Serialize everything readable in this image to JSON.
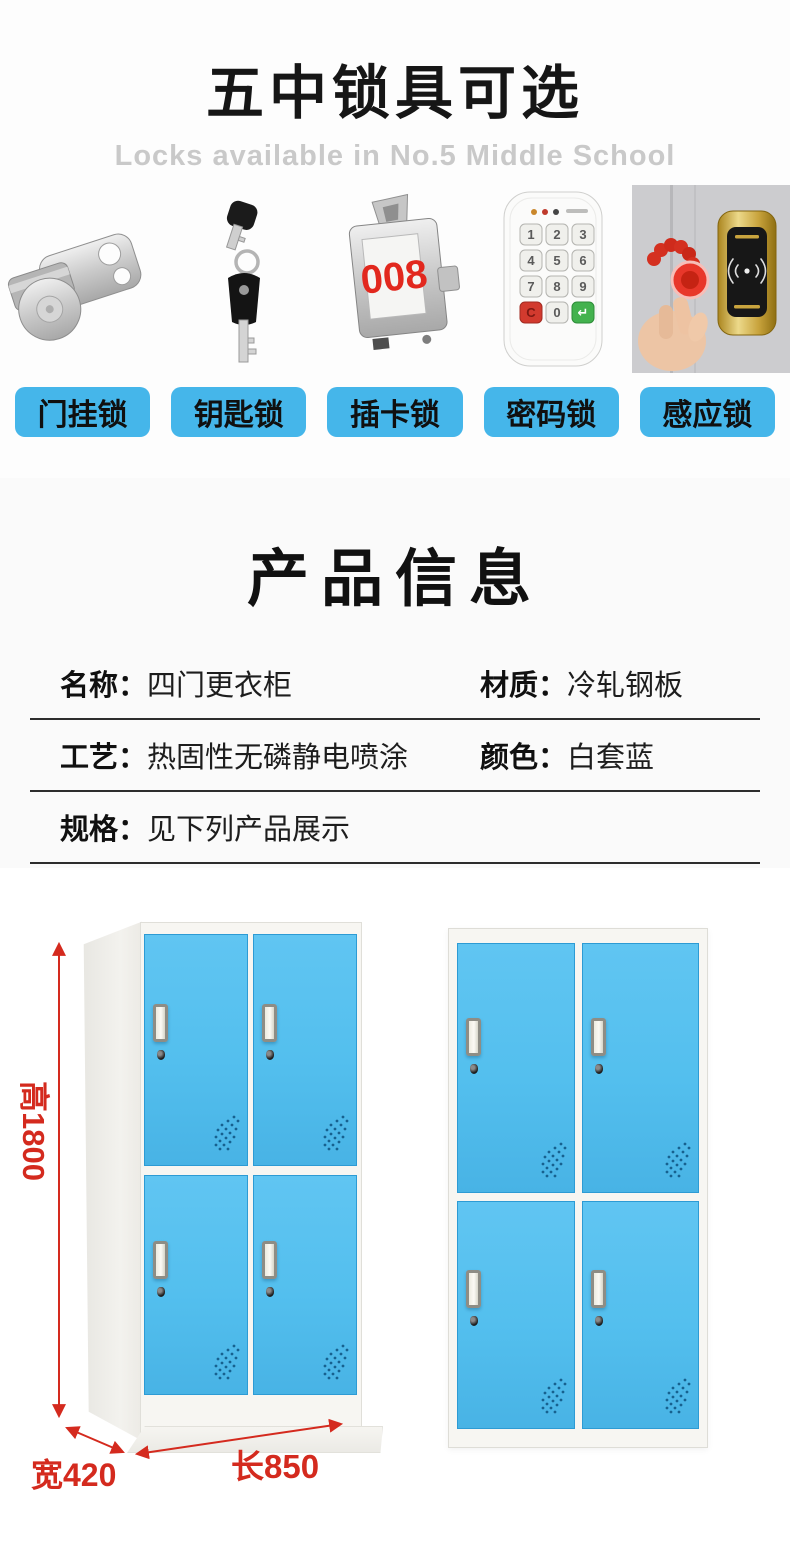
{
  "locks_section": {
    "title": "五中锁具可选",
    "subtitle": "Locks available in No.5 Middle School",
    "items": [
      {
        "label": "门挂锁",
        "image": "cam-lock"
      },
      {
        "label": "钥匙锁",
        "image": "key-lock"
      },
      {
        "label": "插卡锁",
        "image": "card-lock",
        "display": "008"
      },
      {
        "label": "密码锁",
        "image": "keypad-lock",
        "keys": [
          "1",
          "2",
          "3",
          "4",
          "5",
          "6",
          "7",
          "8",
          "9",
          "C",
          "0",
          "↵"
        ]
      },
      {
        "label": "感应锁",
        "image": "rfid-lock"
      }
    ]
  },
  "product_info": {
    "title": "产品信息",
    "fields": [
      {
        "label": "名称：",
        "value": "四门更衣柜"
      },
      {
        "label": "材质：",
        "value": "冷轧钢板"
      },
      {
        "label": "工艺：",
        "value": "热固性无磷静电喷涂"
      },
      {
        "label": "颜色：",
        "value": "白套蓝"
      },
      {
        "label": "规格：",
        "value": "见下列产品展示"
      }
    ]
  },
  "product_display": {
    "height_label": "高1800",
    "width_label": "宽420",
    "length_label": "长850"
  },
  "colors": {
    "chip_blue": "#45b6ea",
    "door_blue": "#53bfee",
    "dimension_red": "#d42a1e",
    "card_digits_red": "#e2281e"
  }
}
